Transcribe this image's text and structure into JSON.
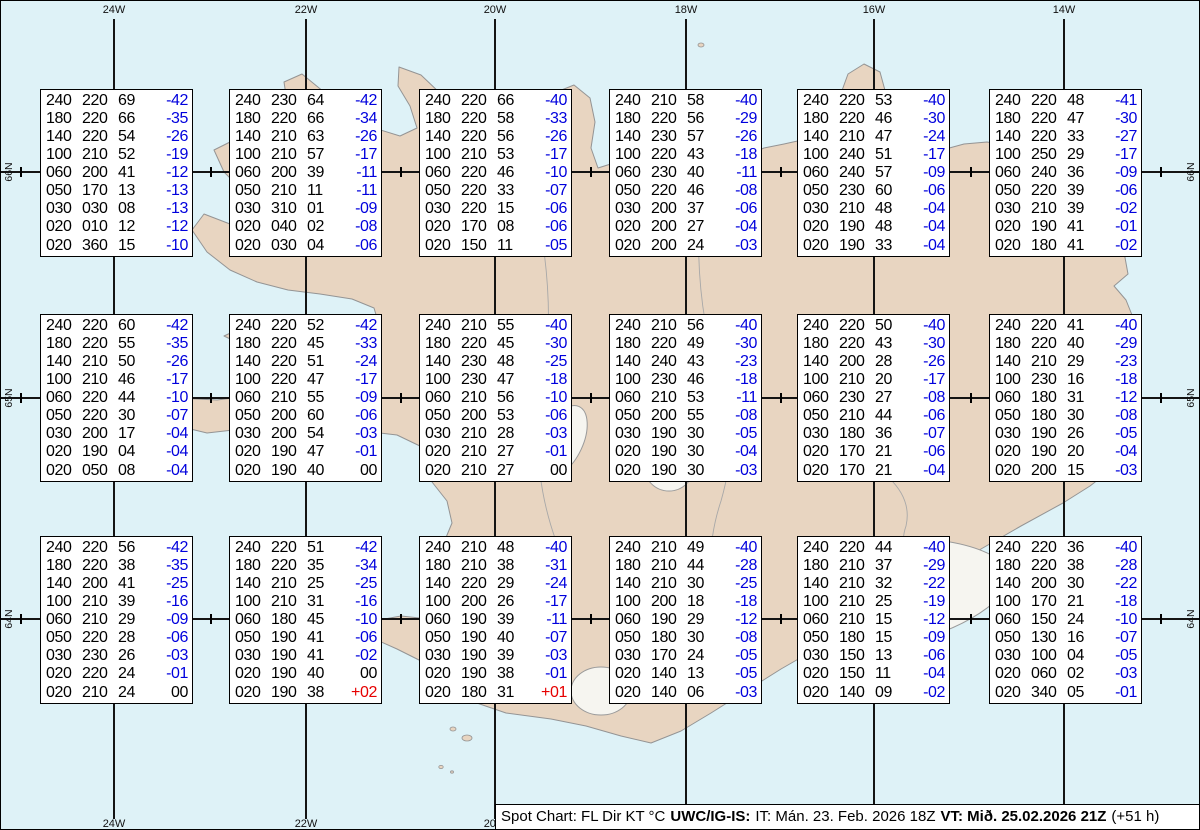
{
  "map": {
    "meridian_labels": [
      "24W",
      "22W",
      "20W",
      "18W",
      "16W",
      "14W"
    ],
    "parallel_labels": [
      "66N",
      "65N",
      "64N"
    ]
  },
  "footer": {
    "chart_label": "Spot Chart: FL Dir KT °C",
    "source": "UWC/IG-IS:",
    "issue": "IT: Mán. 23. Feb. 2026 18Z",
    "valid": "VT: Mið. 25.02.2026 21Z",
    "lead": "(+51 h)"
  },
  "columns": [
    "flight-level",
    "wind-direction",
    "wind-speed-kt",
    "temperature-c"
  ],
  "colors": {
    "temp_negative": "#0000dd",
    "temp_positive": "#e60000",
    "temp_zero": "#000000",
    "ocean": "#def2f7",
    "land": "#e8d5c1"
  },
  "spot_boxes": [
    {
      "rows": [
        [
          "240",
          "220",
          "69",
          "-42"
        ],
        [
          "180",
          "220",
          "66",
          "-35"
        ],
        [
          "140",
          "220",
          "54",
          "-26"
        ],
        [
          "100",
          "210",
          "52",
          "-19"
        ],
        [
          "060",
          "200",
          "41",
          "-12"
        ],
        [
          "050",
          "170",
          "13",
          "-13"
        ],
        [
          "030",
          "030",
          "08",
          "-13"
        ],
        [
          "020",
          "010",
          "12",
          "-12"
        ],
        [
          "020",
          "360",
          "15",
          "-10"
        ]
      ]
    },
    {
      "rows": [
        [
          "240",
          "230",
          "64",
          "-42"
        ],
        [
          "180",
          "220",
          "66",
          "-34"
        ],
        [
          "140",
          "210",
          "63",
          "-26"
        ],
        [
          "100",
          "210",
          "57",
          "-17"
        ],
        [
          "060",
          "200",
          "39",
          "-11"
        ],
        [
          "050",
          "210",
          "11",
          "-11"
        ],
        [
          "030",
          "310",
          "01",
          "-09"
        ],
        [
          "020",
          "040",
          "02",
          "-08"
        ],
        [
          "020",
          "030",
          "04",
          "-06"
        ]
      ]
    },
    {
      "rows": [
        [
          "240",
          "220",
          "66",
          "-40"
        ],
        [
          "180",
          "220",
          "58",
          "-33"
        ],
        [
          "140",
          "220",
          "56",
          "-26"
        ],
        [
          "100",
          "210",
          "53",
          "-17"
        ],
        [
          "060",
          "220",
          "46",
          "-10"
        ],
        [
          "050",
          "220",
          "33",
          "-07"
        ],
        [
          "030",
          "220",
          "15",
          "-06"
        ],
        [
          "020",
          "170",
          "08",
          "-06"
        ],
        [
          "020",
          "150",
          "11",
          "-05"
        ]
      ]
    },
    {
      "rows": [
        [
          "240",
          "210",
          "58",
          "-40"
        ],
        [
          "180",
          "220",
          "56",
          "-29"
        ],
        [
          "140",
          "230",
          "57",
          "-26"
        ],
        [
          "100",
          "220",
          "43",
          "-18"
        ],
        [
          "060",
          "230",
          "40",
          "-11"
        ],
        [
          "050",
          "220",
          "46",
          "-08"
        ],
        [
          "030",
          "200",
          "37",
          "-06"
        ],
        [
          "020",
          "200",
          "27",
          "-04"
        ],
        [
          "020",
          "200",
          "24",
          "-03"
        ]
      ]
    },
    {
      "rows": [
        [
          "240",
          "220",
          "53",
          "-40"
        ],
        [
          "180",
          "220",
          "46",
          "-30"
        ],
        [
          "140",
          "210",
          "47",
          "-24"
        ],
        [
          "100",
          "240",
          "51",
          "-17"
        ],
        [
          "060",
          "240",
          "57",
          "-09"
        ],
        [
          "050",
          "230",
          "60",
          "-06"
        ],
        [
          "030",
          "210",
          "48",
          "-04"
        ],
        [
          "020",
          "190",
          "48",
          "-04"
        ],
        [
          "020",
          "190",
          "33",
          "-04"
        ]
      ]
    },
    {
      "rows": [
        [
          "240",
          "220",
          "48",
          "-41"
        ],
        [
          "180",
          "220",
          "47",
          "-30"
        ],
        [
          "140",
          "220",
          "33",
          "-27"
        ],
        [
          "100",
          "250",
          "29",
          "-17"
        ],
        [
          "060",
          "240",
          "36",
          "-09"
        ],
        [
          "050",
          "220",
          "39",
          "-06"
        ],
        [
          "030",
          "210",
          "39",
          "-02"
        ],
        [
          "020",
          "190",
          "41",
          "-01"
        ],
        [
          "020",
          "180",
          "41",
          "-02"
        ]
      ]
    },
    {
      "rows": [
        [
          "240",
          "220",
          "60",
          "-42"
        ],
        [
          "180",
          "220",
          "55",
          "-35"
        ],
        [
          "140",
          "210",
          "50",
          "-26"
        ],
        [
          "100",
          "210",
          "46",
          "-17"
        ],
        [
          "060",
          "220",
          "44",
          "-10"
        ],
        [
          "050",
          "220",
          "30",
          "-07"
        ],
        [
          "030",
          "200",
          "17",
          "-04"
        ],
        [
          "020",
          "190",
          "04",
          "-04"
        ],
        [
          "020",
          "050",
          "08",
          "-04"
        ]
      ]
    },
    {
      "rows": [
        [
          "240",
          "220",
          "52",
          "-42"
        ],
        [
          "180",
          "220",
          "45",
          "-33"
        ],
        [
          "140",
          "220",
          "51",
          "-24"
        ],
        [
          "100",
          "220",
          "47",
          "-17"
        ],
        [
          "060",
          "210",
          "55",
          "-09"
        ],
        [
          "050",
          "200",
          "60",
          "-06"
        ],
        [
          "030",
          "200",
          "54",
          "-03"
        ],
        [
          "020",
          "190",
          "47",
          "-01"
        ],
        [
          "020",
          "190",
          "40",
          "00"
        ]
      ]
    },
    {
      "rows": [
        [
          "240",
          "210",
          "55",
          "-40"
        ],
        [
          "180",
          "220",
          "45",
          "-30"
        ],
        [
          "140",
          "230",
          "48",
          "-25"
        ],
        [
          "100",
          "230",
          "47",
          "-18"
        ],
        [
          "060",
          "210",
          "56",
          "-10"
        ],
        [
          "050",
          "200",
          "53",
          "-06"
        ],
        [
          "030",
          "210",
          "28",
          "-03"
        ],
        [
          "020",
          "210",
          "27",
          "-01"
        ],
        [
          "020",
          "210",
          "27",
          "00"
        ]
      ]
    },
    {
      "rows": [
        [
          "240",
          "210",
          "56",
          "-40"
        ],
        [
          "180",
          "220",
          "49",
          "-30"
        ],
        [
          "140",
          "240",
          "43",
          "-23"
        ],
        [
          "100",
          "230",
          "46",
          "-18"
        ],
        [
          "060",
          "210",
          "53",
          "-11"
        ],
        [
          "050",
          "200",
          "55",
          "-08"
        ],
        [
          "030",
          "190",
          "30",
          "-05"
        ],
        [
          "020",
          "190",
          "30",
          "-04"
        ],
        [
          "020",
          "190",
          "30",
          "-03"
        ]
      ]
    },
    {
      "rows": [
        [
          "240",
          "220",
          "50",
          "-40"
        ],
        [
          "180",
          "220",
          "43",
          "-30"
        ],
        [
          "140",
          "200",
          "28",
          "-26"
        ],
        [
          "100",
          "210",
          "20",
          "-17"
        ],
        [
          "060",
          "230",
          "27",
          "-08"
        ],
        [
          "050",
          "210",
          "44",
          "-06"
        ],
        [
          "030",
          "180",
          "36",
          "-07"
        ],
        [
          "020",
          "170",
          "21",
          "-06"
        ],
        [
          "020",
          "170",
          "21",
          "-04"
        ]
      ]
    },
    {
      "rows": [
        [
          "240",
          "220",
          "41",
          "-40"
        ],
        [
          "180",
          "220",
          "40",
          "-29"
        ],
        [
          "140",
          "210",
          "29",
          "-23"
        ],
        [
          "100",
          "230",
          "16",
          "-18"
        ],
        [
          "060",
          "180",
          "31",
          "-12"
        ],
        [
          "050",
          "180",
          "30",
          "-08"
        ],
        [
          "030",
          "190",
          "26",
          "-05"
        ],
        [
          "020",
          "190",
          "20",
          "-04"
        ],
        [
          "020",
          "200",
          "15",
          "-03"
        ]
      ]
    },
    {
      "rows": [
        [
          "240",
          "220",
          "56",
          "-42"
        ],
        [
          "180",
          "220",
          "38",
          "-35"
        ],
        [
          "140",
          "200",
          "41",
          "-25"
        ],
        [
          "100",
          "210",
          "39",
          "-16"
        ],
        [
          "060",
          "210",
          "29",
          "-09"
        ],
        [
          "050",
          "220",
          "28",
          "-06"
        ],
        [
          "030",
          "230",
          "26",
          "-03"
        ],
        [
          "020",
          "220",
          "24",
          "-01"
        ],
        [
          "020",
          "210",
          "24",
          "00"
        ]
      ]
    },
    {
      "rows": [
        [
          "240",
          "220",
          "51",
          "-42"
        ],
        [
          "180",
          "220",
          "35",
          "-34"
        ],
        [
          "140",
          "210",
          "25",
          "-25"
        ],
        [
          "100",
          "210",
          "31",
          "-16"
        ],
        [
          "060",
          "180",
          "45",
          "-10"
        ],
        [
          "050",
          "190",
          "41",
          "-06"
        ],
        [
          "030",
          "190",
          "41",
          "-02"
        ],
        [
          "020",
          "190",
          "40",
          "00"
        ],
        [
          "020",
          "190",
          "38",
          "+02"
        ]
      ]
    },
    {
      "rows": [
        [
          "240",
          "210",
          "48",
          "-40"
        ],
        [
          "180",
          "210",
          "38",
          "-31"
        ],
        [
          "140",
          "220",
          "29",
          "-24"
        ],
        [
          "100",
          "200",
          "26",
          "-17"
        ],
        [
          "060",
          "190",
          "39",
          "-11"
        ],
        [
          "050",
          "190",
          "40",
          "-07"
        ],
        [
          "030",
          "190",
          "39",
          "-03"
        ],
        [
          "020",
          "190",
          "38",
          "-01"
        ],
        [
          "020",
          "180",
          "31",
          "+01"
        ]
      ]
    },
    {
      "rows": [
        [
          "240",
          "210",
          "49",
          "-40"
        ],
        [
          "180",
          "210",
          "44",
          "-28"
        ],
        [
          "140",
          "210",
          "30",
          "-25"
        ],
        [
          "100",
          "200",
          "18",
          "-18"
        ],
        [
          "060",
          "190",
          "29",
          "-12"
        ],
        [
          "050",
          "180",
          "30",
          "-08"
        ],
        [
          "030",
          "170",
          "24",
          "-05"
        ],
        [
          "020",
          "140",
          "13",
          "-05"
        ],
        [
          "020",
          "140",
          "06",
          "-03"
        ]
      ]
    },
    {
      "rows": [
        [
          "240",
          "220",
          "44",
          "-40"
        ],
        [
          "180",
          "210",
          "37",
          "-29"
        ],
        [
          "140",
          "210",
          "32",
          "-22"
        ],
        [
          "100",
          "210",
          "25",
          "-19"
        ],
        [
          "060",
          "210",
          "15",
          "-12"
        ],
        [
          "050",
          "180",
          "15",
          "-09"
        ],
        [
          "030",
          "150",
          "13",
          "-06"
        ],
        [
          "020",
          "150",
          "11",
          "-04"
        ],
        [
          "020",
          "140",
          "09",
          "-02"
        ]
      ]
    },
    {
      "rows": [
        [
          "240",
          "220",
          "36",
          "-40"
        ],
        [
          "180",
          "220",
          "38",
          "-28"
        ],
        [
          "140",
          "200",
          "30",
          "-22"
        ],
        [
          "100",
          "170",
          "21",
          "-18"
        ],
        [
          "060",
          "150",
          "24",
          "-10"
        ],
        [
          "050",
          "130",
          "16",
          "-07"
        ],
        [
          "030",
          "100",
          "04",
          "-05"
        ],
        [
          "020",
          "060",
          "02",
          "-03"
        ],
        [
          "020",
          "340",
          "05",
          "-01"
        ]
      ]
    }
  ]
}
